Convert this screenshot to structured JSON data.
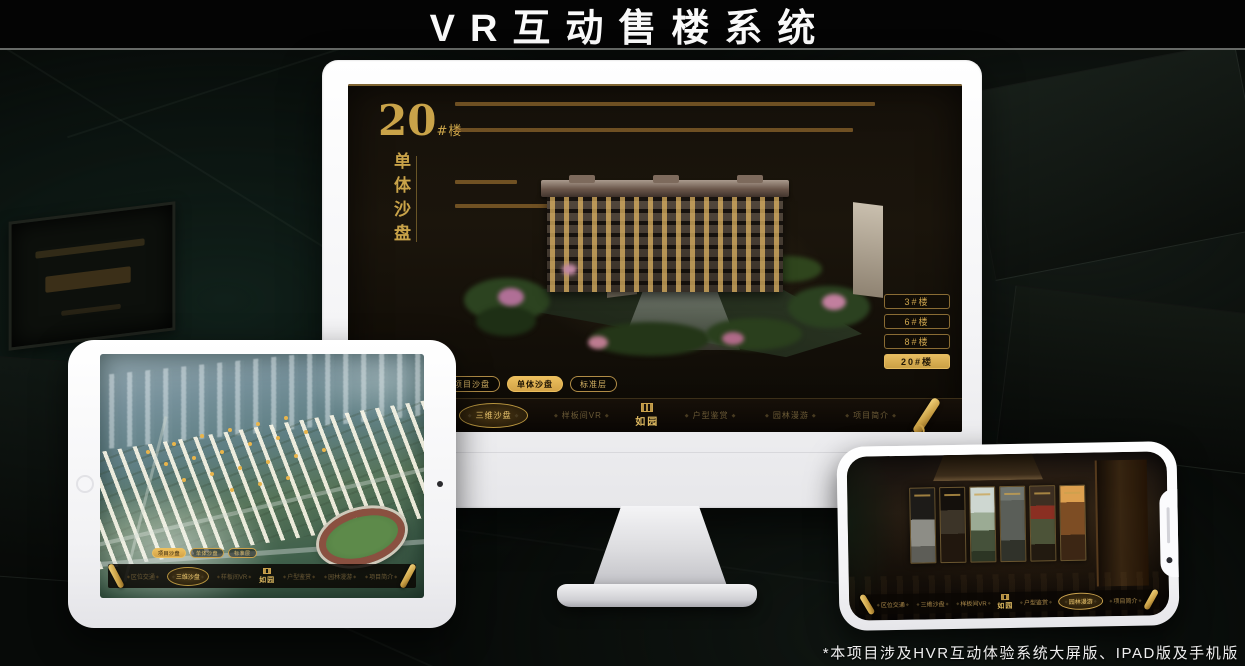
{
  "page": {
    "title": "VR互动售楼系统",
    "footnote": "*本项目涉及HVR互动体验系统大屏版、IPAD版及手机版"
  },
  "colors": {
    "gold": "#c9a349",
    "gold_bright": "#ecbf5e",
    "screen_bg": "#16110a",
    "nav_bg": "#0a0603"
  },
  "monitor": {
    "headline": {
      "number": "20",
      "suffix": "#楼",
      "vertical": "单体沙盘"
    },
    "tabs": [
      {
        "label": "项目沙盘",
        "active": false
      },
      {
        "label": "单体沙盘",
        "active": true
      },
      {
        "label": "标准层",
        "active": false
      }
    ],
    "buttons": [
      {
        "label": "3#楼",
        "active": false
      },
      {
        "label": "6#楼",
        "active": false
      },
      {
        "label": "8#楼",
        "active": false
      },
      {
        "label": "20#楼",
        "active": true
      }
    ],
    "nav": {
      "logo": "如园",
      "items": [
        {
          "label": "区位交通",
          "active": false
        },
        {
          "label": "三维沙盘",
          "active": true
        },
        {
          "label": "样板间VR",
          "active": false
        },
        {
          "label": "户型鉴赏",
          "active": false
        },
        {
          "label": "园林漫游",
          "active": false
        },
        {
          "label": "项目简介",
          "active": false
        }
      ]
    }
  },
  "tablet": {
    "tabs": [
      {
        "label": "项目沙盘",
        "active": true
      },
      {
        "label": "单体沙盘",
        "active": false
      },
      {
        "label": "标准层",
        "active": false
      }
    ],
    "nav": {
      "logo": "如园",
      "items": [
        {
          "label": "区位交通",
          "active": false
        },
        {
          "label": "三维沙盘",
          "active": true
        },
        {
          "label": "样板间VR",
          "active": false
        },
        {
          "label": "户型鉴赏",
          "active": false
        },
        {
          "label": "园林漫游",
          "active": false
        },
        {
          "label": "项目简介",
          "active": false
        }
      ]
    }
  },
  "phone": {
    "nav": {
      "logo": "如园",
      "items": [
        {
          "label": "区位交通",
          "active": false
        },
        {
          "label": "三维沙盘",
          "active": false
        },
        {
          "label": "样板间VR",
          "active": false
        },
        {
          "label": "户型鉴赏",
          "active": false
        },
        {
          "label": "园林漫游",
          "active": true
        },
        {
          "label": "项目简介",
          "active": false
        }
      ]
    }
  }
}
